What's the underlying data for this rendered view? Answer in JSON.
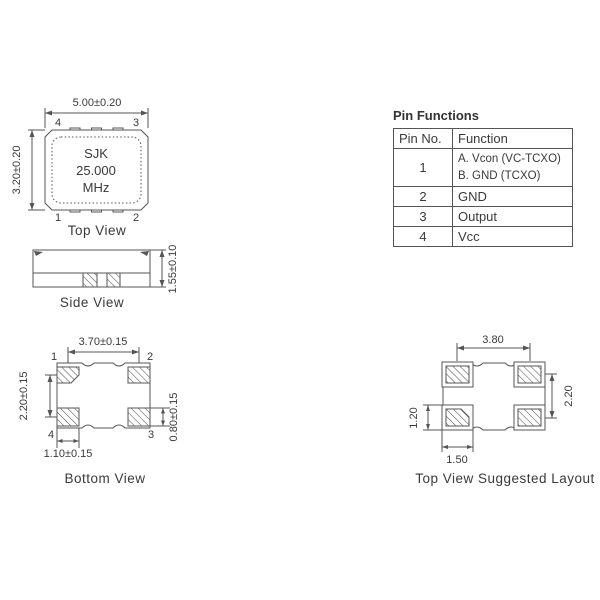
{
  "drawing": {
    "line_color": "#555555",
    "text_color": "#3a3a3a"
  },
  "top_view": {
    "label": "Top View",
    "dim_width": "5.00±0.20",
    "dim_height": "3.20±0.20",
    "marking": [
      "SJK",
      "25.000",
      "MHz"
    ],
    "pins": {
      "top_left": "4",
      "top_right": "3",
      "bottom_left": "1",
      "bottom_right": "2"
    }
  },
  "side_view": {
    "label": "Side View",
    "dim_height": "1.55±0.10"
  },
  "bottom_view": {
    "label": "Bottom View",
    "dim_pad_pitch_x": "3.70±0.15",
    "dim_pad_pitch_y": "2.20±0.15",
    "dim_pad_height": "0.80±0.15",
    "dim_pad_width": "1.10±0.15",
    "pins": {
      "top_left": "1",
      "top_right": "2",
      "bottom_left": "4",
      "bottom_right": "3"
    }
  },
  "layout_view": {
    "label": "Top View Suggested Layout",
    "dim_pad_pitch_x": "3.80",
    "dim_pad_pitch_y": "2.20",
    "dim_pad_height": "1.20",
    "dim_pad_width": "1.50"
  },
  "pin_table": {
    "title": "Pin Functions",
    "col_pin": "Pin No.",
    "col_function": "Function",
    "rows": {
      "r1": {
        "pin": "1",
        "line_a": "A. Vcon (VC-TCXO)",
        "line_b": "B. GND (TCXO)"
      },
      "r2": {
        "pin": "2",
        "fn": "GND"
      },
      "r3": {
        "pin": "3",
        "fn": "Output"
      },
      "r4": {
        "pin": "4",
        "fn": "Vcc"
      }
    }
  }
}
